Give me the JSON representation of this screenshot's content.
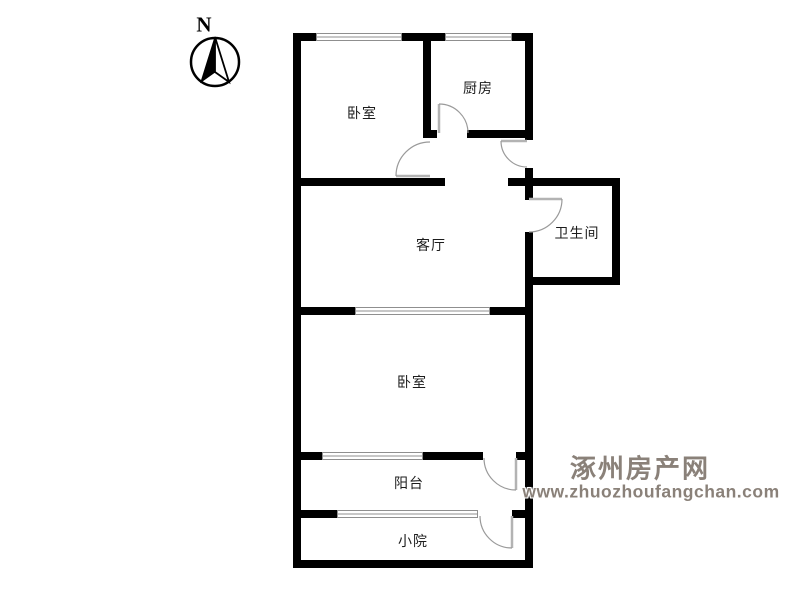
{
  "compass": {
    "label": "N"
  },
  "rooms": [
    {
      "id": "bedroom-top",
      "label": "卧室"
    },
    {
      "id": "kitchen",
      "label": "厨房"
    },
    {
      "id": "living-room",
      "label": "客厅"
    },
    {
      "id": "bathroom",
      "label": "卫生间"
    },
    {
      "id": "bedroom-bottom",
      "label": "卧室"
    },
    {
      "id": "balcony",
      "label": "阳台"
    },
    {
      "id": "yard",
      "label": "小院"
    }
  ],
  "watermark": {
    "site_name": "涿州房产网",
    "url": "www.zhuozhoufangchan.com"
  },
  "colors": {
    "wall": "#000000",
    "door": "#b3b3b3",
    "door_arc": "#9a9a9a",
    "window": "#8f8f8f",
    "label": "#1c1c1c",
    "watermark": "#8a8179"
  }
}
